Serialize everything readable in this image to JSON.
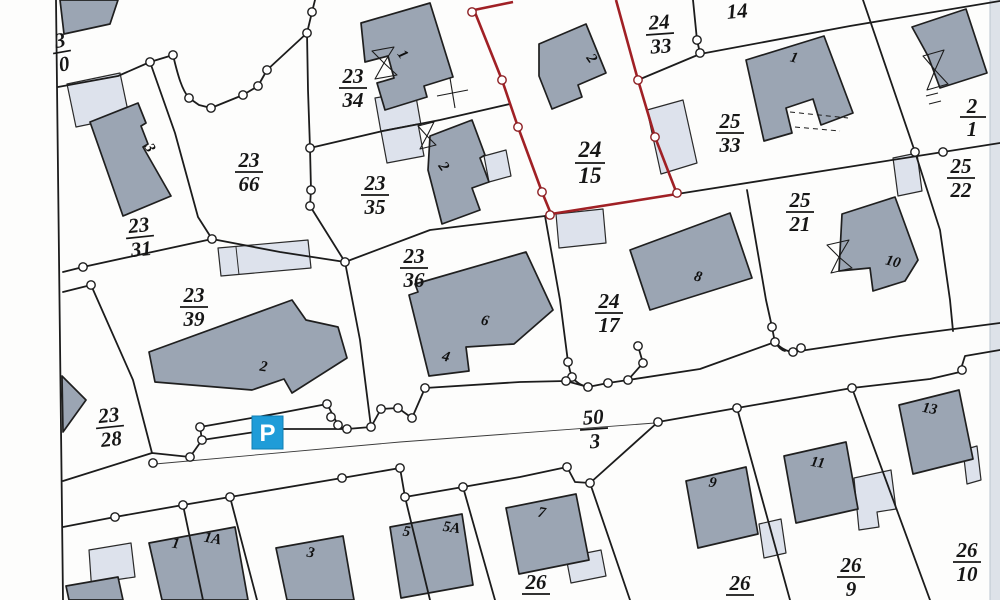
{
  "map": {
    "kind": "cadastral-parcel-map-scan",
    "colors": {
      "building_fill": "#9ba5b3",
      "building_light_fill": "#dde2ec",
      "boundary_line": "#1c1c1c",
      "highlight_boundary_red": "#a02025",
      "parking_blue": "#1f9cd8",
      "paper": "#fdfdfc"
    },
    "highlighted_parcel": "24/15",
    "parcel_labels": {
      "tl_partial": {
        "num": "3",
        "den": "0"
      },
      "p23_66": {
        "num": "23",
        "den": "66"
      },
      "p23_31": {
        "num": "23",
        "den": "31"
      },
      "p23_34": {
        "num": "23",
        "den": "34"
      },
      "p23_35": {
        "num": "23",
        "den": "35"
      },
      "p23_36": {
        "num": "23",
        "den": "36"
      },
      "p23_39": {
        "num": "23",
        "den": "39"
      },
      "p23_28": {
        "num": "23",
        "den": "28"
      },
      "p24_33": {
        "num": "24",
        "den": "33"
      },
      "p24_15": {
        "num": "24",
        "den": "15"
      },
      "p24_17": {
        "num": "24",
        "den": "17"
      },
      "p25_33": {
        "num": "25",
        "den": "33"
      },
      "p25_21": {
        "num": "25",
        "den": "21"
      },
      "p25_22": {
        "num": "25",
        "den": "22"
      },
      "p50_3": {
        "num": "50",
        "den": "3"
      },
      "p26_9": {
        "num": "26",
        "den": "9"
      },
      "p26_10": {
        "num": "26",
        "den": "10"
      },
      "p26_a": {
        "num": "26"
      },
      "p26_b": {
        "num": "26"
      },
      "p14": {
        "num": "14"
      },
      "right_partial": {
        "num": "2",
        "den": "1"
      }
    },
    "building_labels": {
      "bl_3": "3",
      "bl_1_2334": "1",
      "bl_2_2335": "2",
      "bl_2_2415": "2",
      "bl_1_2533": "1",
      "bl_2_2339": "2",
      "bl_6": "6",
      "bl_4": "4",
      "bl_8": "8",
      "bl_10": "10",
      "bl_13": "13",
      "bl_11": "11",
      "bl_9": "9",
      "bl_7": "7",
      "bl_5": "5",
      "bl_5a": "5A",
      "bl_1b": "1",
      "bl_1a": "1A",
      "bl_3b": "3"
    },
    "parking": {
      "label": "P"
    }
  }
}
